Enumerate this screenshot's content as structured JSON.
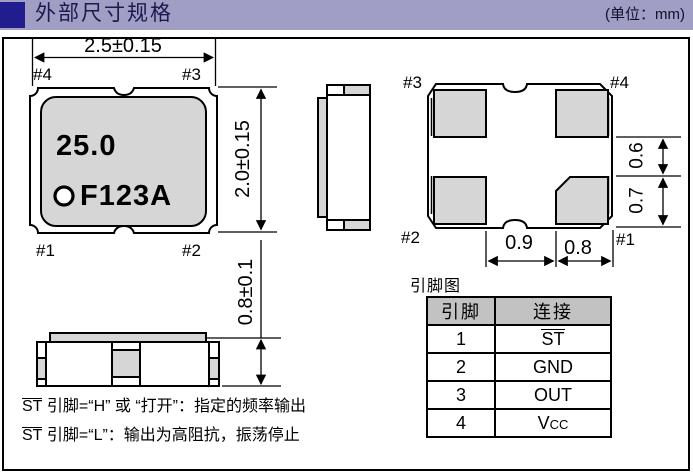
{
  "header": {
    "title": "外部尺寸规格",
    "unit": "(单位：mm)"
  },
  "colors": {
    "accent_bar": "#a09ec4",
    "accent_square": "#211d8e",
    "pad_gray": "#d6d6d6",
    "table_header_bg": "#c2c2c2"
  },
  "top_view": {
    "width_dim": "2.5±0.15",
    "height_dim": "2.0±0.15",
    "pins": {
      "top_left": "#4",
      "top_right": "#3",
      "bottom_left": "#1",
      "bottom_right": "#2"
    },
    "marking_frequency": "25.0",
    "marking_code": "F123A"
  },
  "side_view": {
    "height_dim": "0.8±0.1"
  },
  "bottom_view": {
    "pins": {
      "top_left": "#3",
      "top_right": "#4",
      "bottom_left": "#2",
      "bottom_right": "#1"
    },
    "dims": {
      "right_upper": "0.6",
      "right_lower": "0.7",
      "bottom_left_span": "0.9",
      "bottom_right_span": "0.8"
    }
  },
  "pin_table": {
    "title": "引脚图",
    "headers": [
      "引脚",
      "连接"
    ],
    "rows": [
      {
        "pin": "1",
        "conn": "ST",
        "style": "overline"
      },
      {
        "pin": "2",
        "conn": "GND",
        "style": "plain"
      },
      {
        "pin": "3",
        "conn": "OUT",
        "style": "plain"
      },
      {
        "pin": "4",
        "conn": "Vcc",
        "style": "vcc"
      }
    ]
  },
  "notes": [
    {
      "signal": "ST",
      "text": " 引脚=“H” 或 “打开”：指定的频率输出"
    },
    {
      "signal": "ST",
      "text": " 引脚=“L”：输出为高阻抗，振荡停止"
    }
  ]
}
